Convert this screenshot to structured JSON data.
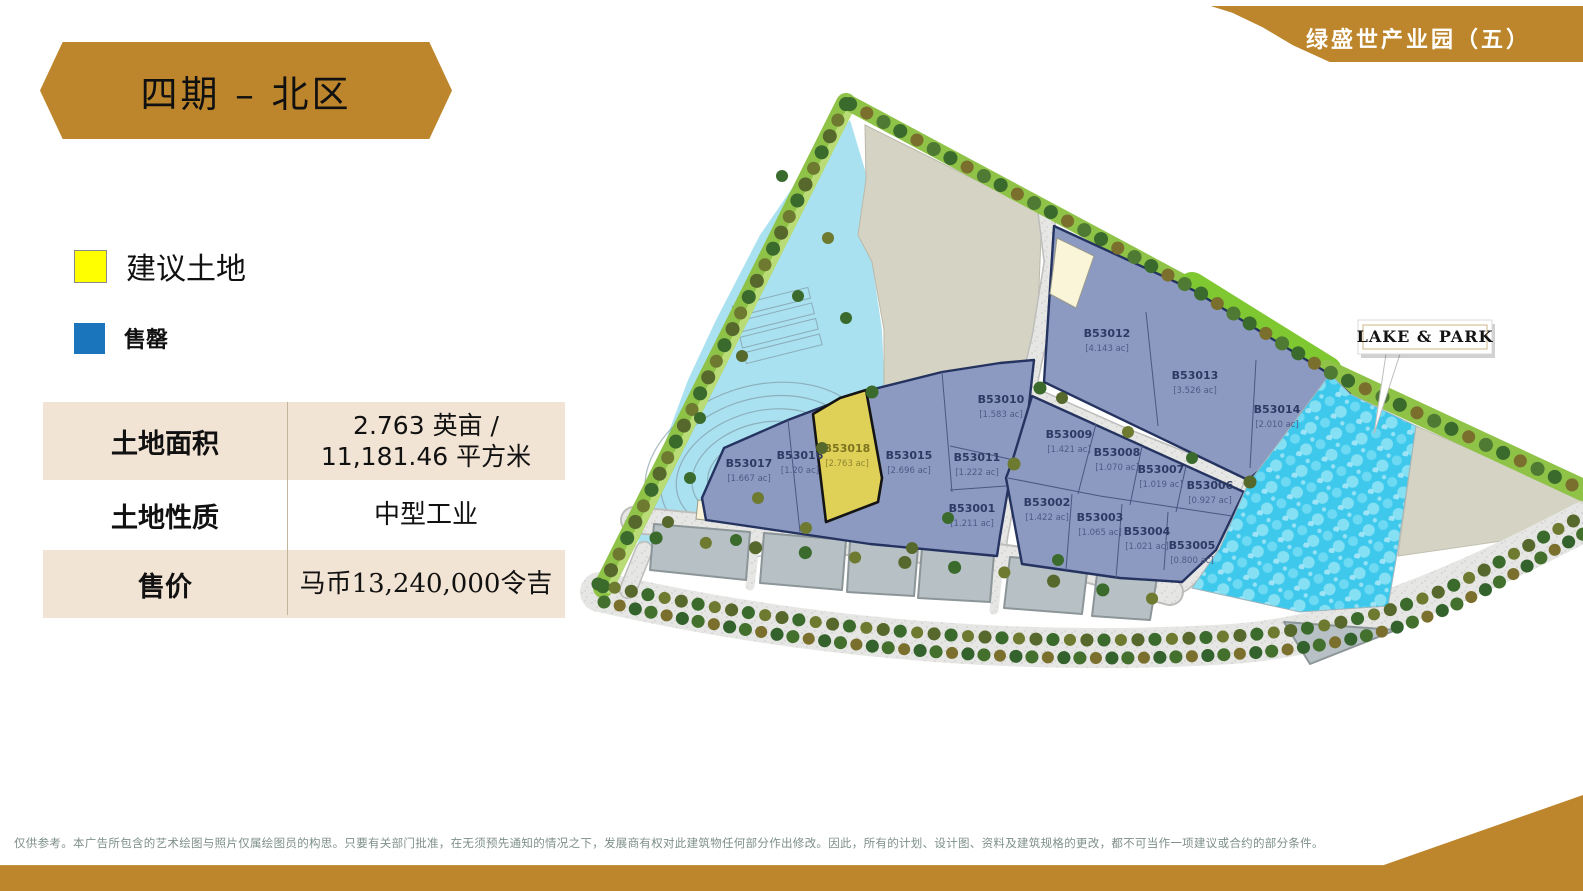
{
  "page": {
    "ribbon_label": "绿盛世产业园（五）",
    "title_banner": "四期 – 北区"
  },
  "legend": {
    "proposed_label": "建议土地",
    "sold_label": "售罄"
  },
  "info_table": {
    "rows": [
      {
        "label": "土地面积",
        "value": "2.763 英亩 / 11,181.46 平方米"
      },
      {
        "label": "土地性质",
        "value": "中型工业"
      },
      {
        "label": "售价",
        "value": "马币13,240,000令吉"
      }
    ]
  },
  "map": {
    "lake_park_label": "LAKE & PARK",
    "plots": [
      {
        "id": "B53001",
        "area": "[1.211 ac]",
        "status": "sold"
      },
      {
        "id": "B53002",
        "area": "[1.422 ac]",
        "status": "sold"
      },
      {
        "id": "B53003",
        "area": "[1.065 ac]",
        "status": "sold"
      },
      {
        "id": "B53004",
        "area": "[1.021 ac]",
        "status": "sold"
      },
      {
        "id": "B53005",
        "area": "[0.800 ac]",
        "status": "sold"
      },
      {
        "id": "B53006",
        "area": "[0.927 ac]",
        "status": "sold"
      },
      {
        "id": "B53007",
        "area": "[1.019 ac]",
        "status": "sold"
      },
      {
        "id": "B53008",
        "area": "[1.070 ac]",
        "status": "sold"
      },
      {
        "id": "B53009",
        "area": "[1.421 ac]",
        "status": "sold"
      },
      {
        "id": "B53010",
        "area": "[1.583 ac]",
        "status": "sold"
      },
      {
        "id": "B53011",
        "area": "[1.222 ac]",
        "status": "sold"
      },
      {
        "id": "B53012",
        "area": "[4.143 ac]",
        "status": "sold"
      },
      {
        "id": "B53013",
        "area": "[3.526 ac]",
        "status": "sold"
      },
      {
        "id": "B53014",
        "area": "[2.010 ac]",
        "status": "sold"
      },
      {
        "id": "B53015",
        "area": "[2.696 ac]",
        "status": "sold"
      },
      {
        "id": "B53016",
        "area": "[1.20 ac]",
        "status": "sold"
      },
      {
        "id": "B53017",
        "area": "[1.667 ac]",
        "status": "sold"
      },
      {
        "id": "B53018",
        "area": "[2.763 ac]",
        "status": "proposed"
      }
    ]
  },
  "footer": {
    "disclaimer": "仅供参考。本广告所包含的艺术绘图与照片仅属绘图员的构思。只要有关部门批准，在无须预先通知的情况之下，发展商有权对此建筑物任何部分作出修改。因此，所有的计划、设计图、资料及建筑规格的更改，都不可当作一项建议或合约的部分条件。"
  },
  "colors": {
    "gold": "#BD862C",
    "proposed_yellow": "#FFFF00",
    "sold_blue": "#1B75BC",
    "plot_fill": "#8C9AC2",
    "plot_border": "#24335F",
    "table_beige": "#F2E4D4",
    "lake_cyan": "#3EC9EC",
    "pond_cyan": "#A9E1F0"
  }
}
